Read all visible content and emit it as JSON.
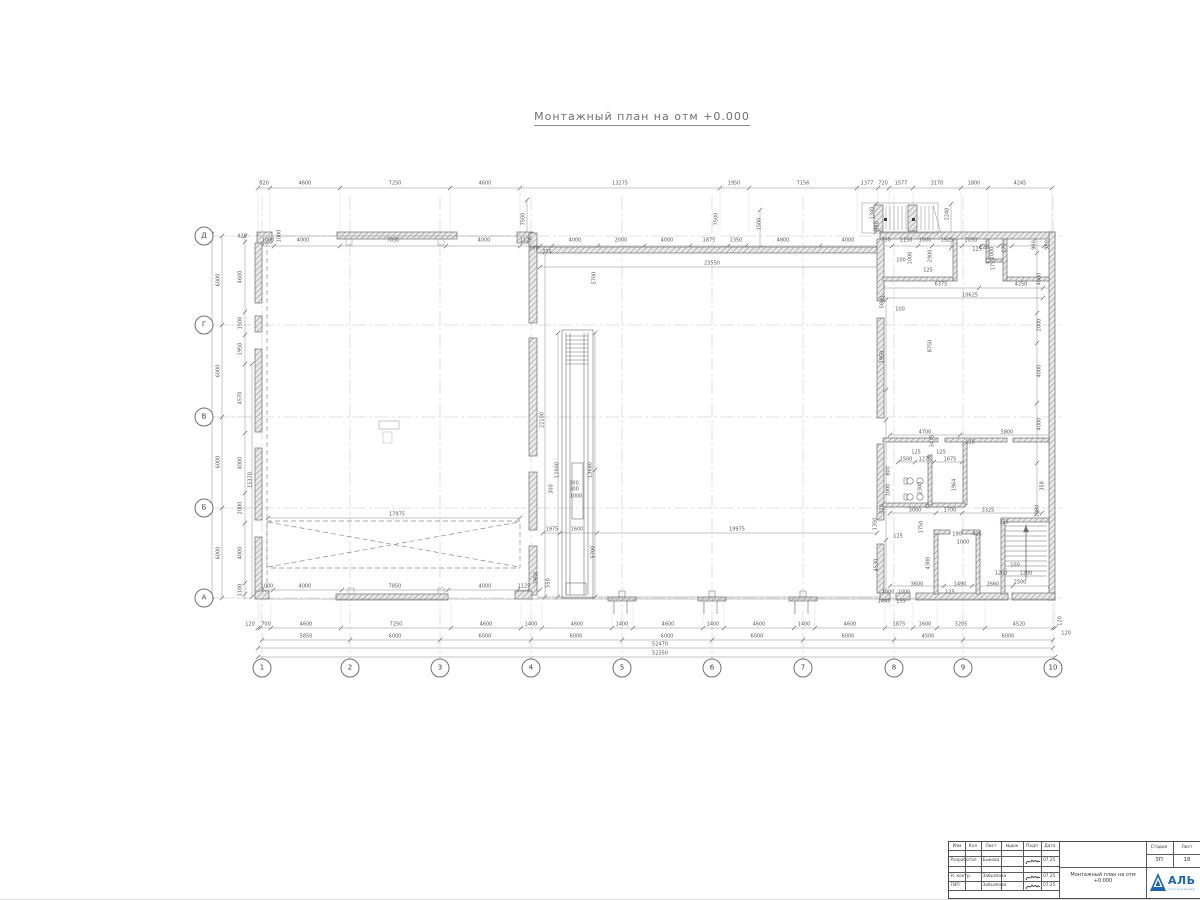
{
  "page": {
    "title": "Монтажный план на отм +0.000"
  },
  "colors": {
    "line": "#6e6e6e",
    "dim": "#5a5a5a",
    "grid": "#c4c4c4",
    "hatch": "#9a9a9a",
    "blue": "#1a64ad"
  },
  "axes": {
    "circle_y": 668,
    "circle_x": 204,
    "cols": [
      {
        "label": "1",
        "x": 262
      },
      {
        "label": "2",
        "x": 350
      },
      {
        "label": "3",
        "x": 440
      },
      {
        "label": "4",
        "x": 531
      },
      {
        "label": "5",
        "x": 622
      },
      {
        "label": "6",
        "x": 712
      },
      {
        "label": "7",
        "x": 803
      },
      {
        "label": "8",
        "x": 894
      },
      {
        "label": "9",
        "x": 963
      },
      {
        "label": "10",
        "x": 1053
      }
    ],
    "rows": [
      {
        "label": "Д",
        "y": 236
      },
      {
        "label": "Г",
        "y": 325
      },
      {
        "label": "В",
        "y": 417
      },
      {
        "label": "Б",
        "y": 508
      },
      {
        "label": "А",
        "y": 598
      }
    ]
  },
  "chains": {
    "h": [
      {
        "y": 188,
        "a": 258,
        "b": 1052,
        "div": [
          258,
          270,
          340,
          450,
          520,
          720,
          749,
          857,
          878,
          889,
          913,
          961,
          988,
          1052
        ],
        "ext": [
          192,
          231
        ]
      },
      {
        "y": 246,
        "a": 258,
        "b": 1053,
        "div": [
          258,
          262,
          274,
          340,
          446,
          520,
          532,
          540,
          552,
          598,
          644,
          690,
          728,
          746,
          820,
          877,
          882,
          892,
          918,
          932,
          962,
          981,
          987,
          999,
          1012,
          1044,
          1053
        ]
      },
      {
        "y": 628,
        "a": 258,
        "b": 1055,
        "div": [
          258,
          260,
          271,
          341,
          451,
          521,
          542,
          612,
          633,
          703,
          724,
          794,
          815,
          885,
          913,
          937,
          985,
          1053,
          1055
        ],
        "ext": [
          602,
          625
        ]
      },
      {
        "y": 640,
        "a": 262,
        "b": 1053,
        "div": [
          262,
          350,
          440,
          531,
          622,
          712,
          803,
          894,
          963,
          1053
        ]
      },
      {
        "y": 648,
        "a": 258,
        "b": 1053,
        "div": [
          258,
          1053
        ]
      },
      {
        "y": 657,
        "a": 258,
        "b": 1055,
        "div": [
          258,
          1055
        ]
      },
      {
        "y": 267,
        "a": 540,
        "b": 880,
        "div": [
          540,
          880
        ]
      },
      {
        "y": 533,
        "a": 543,
        "b": 877,
        "div": [
          543,
          560,
          597,
          877
        ]
      },
      {
        "y": 288,
        "a": 883,
        "b": 1053,
        "div": [
          883,
          979,
          1043
        ]
      },
      {
        "y": 298,
        "a": 883,
        "b": 1043,
        "div": [
          883,
          1043
        ]
      },
      {
        "y": 435,
        "a": 890,
        "b": 1053,
        "div": [
          890,
          960,
          1053
        ]
      },
      {
        "y": 462,
        "a": 898,
        "b": 962,
        "div": [
          898,
          915,
          934,
          962
        ]
      },
      {
        "y": 513,
        "a": 890,
        "b": 1042,
        "div": [
          890,
          936,
          962,
          1042
        ]
      },
      {
        "y": 586,
        "a": 890,
        "b": 1050,
        "div": [
          890,
          944,
          972,
          1013,
          1050
        ]
      },
      {
        "y": 518,
        "a": 268,
        "b": 520,
        "div": [
          268,
          520
        ]
      },
      {
        "y": 590,
        "a": 258,
        "b": 540,
        "div": [
          258,
          262,
          273,
          342,
          448,
          518,
          528,
          540
        ]
      }
    ],
    "v": [
      {
        "x": 222,
        "a": 236,
        "b": 598,
        "div": [
          236,
          325,
          417,
          508,
          598
        ],
        "ext": [
          226,
          252
        ]
      },
      {
        "x": 212,
        "a": 234,
        "b": 600,
        "div": [
          234,
          600
        ]
      },
      {
        "x": 245,
        "a": 236,
        "b": 600,
        "div": [
          236,
          242,
          312,
          335,
          364,
          433,
          493,
          523,
          583,
          594
        ]
      },
      {
        "x": 252,
        "a": 364,
        "b": 597,
        "div": [
          364,
          597
        ]
      },
      {
        "x": 545,
        "a": 252,
        "b": 597,
        "div": [
          252,
          597
        ]
      },
      {
        "x": 558,
        "a": 333,
        "b": 597,
        "div": [
          333,
          597
        ]
      },
      {
        "x": 595,
        "a": 333,
        "b": 597,
        "div": [
          333,
          470,
          597
        ]
      },
      {
        "x": 1037,
        "a": 238,
        "b": 513,
        "div": [
          238,
          253,
          313,
          343,
          403,
          463,
          513
        ]
      },
      {
        "x": 886,
        "a": 300,
        "b": 595,
        "div": [
          300,
          390,
          420,
          505,
          540,
          595
        ]
      },
      {
        "x": 527,
        "a": 200,
        "b": 235,
        "div": [
          200,
          235
        ]
      },
      {
        "x": 760,
        "a": 210,
        "b": 248,
        "div": [
          210,
          248
        ]
      },
      {
        "x": 876,
        "a": 204,
        "b": 232,
        "div": [
          204,
          218,
          232
        ]
      },
      {
        "x": 951,
        "a": 204,
        "b": 248,
        "div": [
          204,
          248
        ]
      }
    ]
  },
  "labels": [
    [
      264,
      184,
      "820"
    ],
    [
      305,
      184,
      "4600"
    ],
    [
      395,
      184,
      "7250"
    ],
    [
      485,
      184,
      "4600"
    ],
    [
      620,
      184,
      "13275"
    ],
    [
      734,
      184,
      "1950"
    ],
    [
      803,
      184,
      "7156"
    ],
    [
      867,
      184,
      "1377"
    ],
    [
      883,
      184,
      "720"
    ],
    [
      901,
      184,
      "1577"
    ],
    [
      937,
      184,
      "3170"
    ],
    [
      974,
      184,
      "1800"
    ],
    [
      1020,
      184,
      "4245"
    ],
    [
      268,
      241,
      "1000"
    ],
    [
      280,
      236,
      "1000",
      1
    ],
    [
      303,
      241,
      "4000"
    ],
    [
      393,
      241,
      "7850"
    ],
    [
      484,
      241,
      "4000"
    ],
    [
      526,
      241,
      "1125"
    ],
    [
      534,
      249,
      "100"
    ],
    [
      547,
      253,
      "775"
    ],
    [
      524,
      219,
      "7500",
      1
    ],
    [
      717,
      219,
      "7500",
      1
    ],
    [
      575,
      241,
      "4000"
    ],
    [
      621,
      241,
      "2000"
    ],
    [
      667,
      241,
      "4000"
    ],
    [
      709,
      241,
      "1875"
    ],
    [
      736,
      241,
      "1350"
    ],
    [
      783,
      241,
      "4800"
    ],
    [
      848,
      241,
      "4000"
    ],
    [
      760,
      224,
      "1500",
      1
    ],
    [
      873,
      213,
      "1340",
      1
    ],
    [
      878,
      226,
      "980",
      1
    ],
    [
      948,
      214,
      "2240",
      1
    ],
    [
      886,
      241,
      "750"
    ],
    [
      906,
      241,
      "1150"
    ],
    [
      925,
      241,
      "1000"
    ],
    [
      947,
      241,
      "1925"
    ],
    [
      971,
      241,
      "2050"
    ],
    [
      984,
      248,
      "125"
    ],
    [
      993,
      253,
      "1000",
      1
    ],
    [
      1005,
      248,
      "270",
      1
    ],
    [
      1048,
      245,
      "980",
      1
    ],
    [
      219,
      280,
      "6000",
      1
    ],
    [
      219,
      371,
      "6000",
      1
    ],
    [
      219,
      462,
      "6000",
      1
    ],
    [
      219,
      553,
      "6000",
      1
    ],
    [
      210,
      417,
      "24240",
      1
    ],
    [
      242,
      237,
      "420"
    ],
    [
      241,
      277,
      "4600",
      1
    ],
    [
      241,
      323,
      "1500",
      1
    ],
    [
      241,
      349,
      "1950",
      1
    ],
    [
      241,
      398,
      "4570",
      1
    ],
    [
      241,
      463,
      "4000",
      1
    ],
    [
      241,
      508,
      "2000",
      1
    ],
    [
      241,
      553,
      "4000",
      1
    ],
    [
      241,
      590,
      "1100",
      1
    ],
    [
      251,
      480,
      "15370",
      1
    ],
    [
      250,
      625,
      "120"
    ],
    [
      266,
      625,
      "700"
    ],
    [
      306,
      625,
      "4600"
    ],
    [
      396,
      625,
      "7250"
    ],
    [
      486,
      625,
      "4600"
    ],
    [
      531,
      625,
      "1400"
    ],
    [
      577,
      625,
      "4600"
    ],
    [
      622,
      625,
      "1400"
    ],
    [
      668,
      625,
      "4600"
    ],
    [
      713,
      625,
      "1400"
    ],
    [
      759,
      625,
      "4600"
    ],
    [
      804,
      625,
      "1400"
    ],
    [
      850,
      625,
      "4600"
    ],
    [
      899,
      625,
      "1875"
    ],
    [
      925,
      625,
      "1600"
    ],
    [
      961,
      625,
      "3205"
    ],
    [
      1019,
      625,
      "4520"
    ],
    [
      1061,
      621,
      "120",
      1
    ],
    [
      306,
      637,
      "5850"
    ],
    [
      395,
      637,
      "6000"
    ],
    [
      485,
      637,
      "6000"
    ],
    [
      576,
      637,
      "6000"
    ],
    [
      667,
      637,
      "6000"
    ],
    [
      757,
      637,
      "6000"
    ],
    [
      848,
      637,
      "6000"
    ],
    [
      928,
      637,
      "4500"
    ],
    [
      1008,
      637,
      "6000"
    ],
    [
      1066,
      634,
      "120"
    ],
    [
      660,
      645,
      "52470"
    ],
    [
      660,
      654,
      "52350"
    ],
    [
      712,
      264,
      "23550"
    ],
    [
      543,
      420,
      "22100",
      1
    ],
    [
      558,
      470,
      "12000",
      1
    ],
    [
      591,
      470,
      "13680",
      1
    ],
    [
      595,
      278,
      "5700",
      1
    ],
    [
      594,
      552,
      "5700",
      1
    ],
    [
      552,
      489,
      "300",
      1
    ],
    [
      574,
      484,
      "300"
    ],
    [
      574,
      490,
      "300"
    ],
    [
      576,
      497,
      "1000"
    ],
    [
      552,
      530,
      "1975"
    ],
    [
      577,
      530,
      "1600"
    ],
    [
      737,
      530,
      "19975"
    ],
    [
      549,
      583,
      "550",
      1
    ],
    [
      397,
      515,
      "17975"
    ],
    [
      267,
      587,
      "1000"
    ],
    [
      305,
      587,
      "4000"
    ],
    [
      395,
      587,
      "7850"
    ],
    [
      485,
      587,
      "4000"
    ],
    [
      524,
      587,
      "1125"
    ],
    [
      537,
      578,
      "1950",
      1
    ],
    [
      901,
      261,
      "100"
    ],
    [
      911,
      258,
      "1000",
      1
    ],
    [
      931,
      256,
      "2900",
      1
    ],
    [
      928,
      271,
      "125"
    ],
    [
      977,
      250,
      "125"
    ],
    [
      994,
      264,
      "1755",
      1
    ],
    [
      941,
      285,
      "6375"
    ],
    [
      1021,
      285,
      "4250"
    ],
    [
      970,
      296,
      "10625"
    ],
    [
      883,
      302,
      "5880",
      1
    ],
    [
      900,
      310,
      "100"
    ],
    [
      931,
      346,
      "8750",
      1
    ],
    [
      883,
      357,
      "1950",
      1
    ],
    [
      1040,
      279,
      "4000",
      1
    ],
    [
      1040,
      325,
      "2000",
      1
    ],
    [
      1040,
      371,
      "4000",
      1
    ],
    [
      1035,
      245,
      "980",
      1
    ],
    [
      925,
      433,
      "4700"
    ],
    [
      1007,
      433,
      "5800"
    ],
    [
      933,
      441,
      "3475",
      1
    ],
    [
      970,
      443,
      "125"
    ],
    [
      906,
      460,
      "1500"
    ],
    [
      925,
      460,
      "1275"
    ],
    [
      950,
      460,
      "1675"
    ],
    [
      916,
      453,
      "125"
    ],
    [
      941,
      453,
      "125"
    ],
    [
      921,
      488,
      "2300",
      1
    ],
    [
      955,
      485,
      "1964",
      1
    ],
    [
      889,
      471,
      "800",
      1
    ],
    [
      889,
      490,
      "1000",
      1
    ],
    [
      883,
      509,
      "520",
      1
    ],
    [
      876,
      524,
      "1350",
      1
    ],
    [
      915,
      511,
      "3000"
    ],
    [
      950,
      511,
      "1700"
    ],
    [
      988,
      511,
      "3325"
    ],
    [
      1004,
      523,
      "125"
    ],
    [
      922,
      527,
      "1750",
      1
    ],
    [
      898,
      537,
      "125"
    ],
    [
      957,
      535,
      "190"
    ],
    [
      977,
      535,
      "425"
    ],
    [
      963,
      543,
      "1000"
    ],
    [
      929,
      563,
      "4300",
      1
    ],
    [
      877,
      565,
      "4530",
      1
    ],
    [
      917,
      585,
      "3600"
    ],
    [
      960,
      585,
      "1490"
    ],
    [
      993,
      585,
      "2660"
    ],
    [
      950,
      593,
      "125"
    ],
    [
      1020,
      583,
      "2500"
    ],
    [
      1001,
      574,
      "1200"
    ],
    [
      1026,
      574,
      "1200"
    ],
    [
      1015,
      566,
      "100"
    ],
    [
      888,
      593,
      "1000"
    ],
    [
      904,
      593,
      "1000"
    ],
    [
      884,
      602,
      "1445"
    ],
    [
      901,
      602,
      "155"
    ],
    [
      1043,
      486,
      "358",
      1
    ],
    [
      1038,
      511,
      "1080",
      1
    ],
    [
      1040,
      424,
      "4000",
      1
    ]
  ],
  "titleblock": {
    "header_cols": [
      "Изм",
      "Кол",
      "Лист",
      "№док",
      "Подп",
      "Дата"
    ],
    "rows": [
      {
        "role": "Разработал",
        "name": "Быкова",
        "date": "07.25"
      },
      {
        "role": "Н. контр",
        "name": "Забьялова",
        "date": "07.25"
      },
      {
        "role": "ГИП",
        "name": "Забьялова",
        "date": "07.25"
      }
    ],
    "doc_title": "Монтажный план на отм +0.000",
    "stage_label": "Стадия",
    "sheet_label": "Лист",
    "stage": "ЗП",
    "sheet": "18",
    "logo_text": "АЛЬ",
    "logo_subtext": "строительная"
  }
}
